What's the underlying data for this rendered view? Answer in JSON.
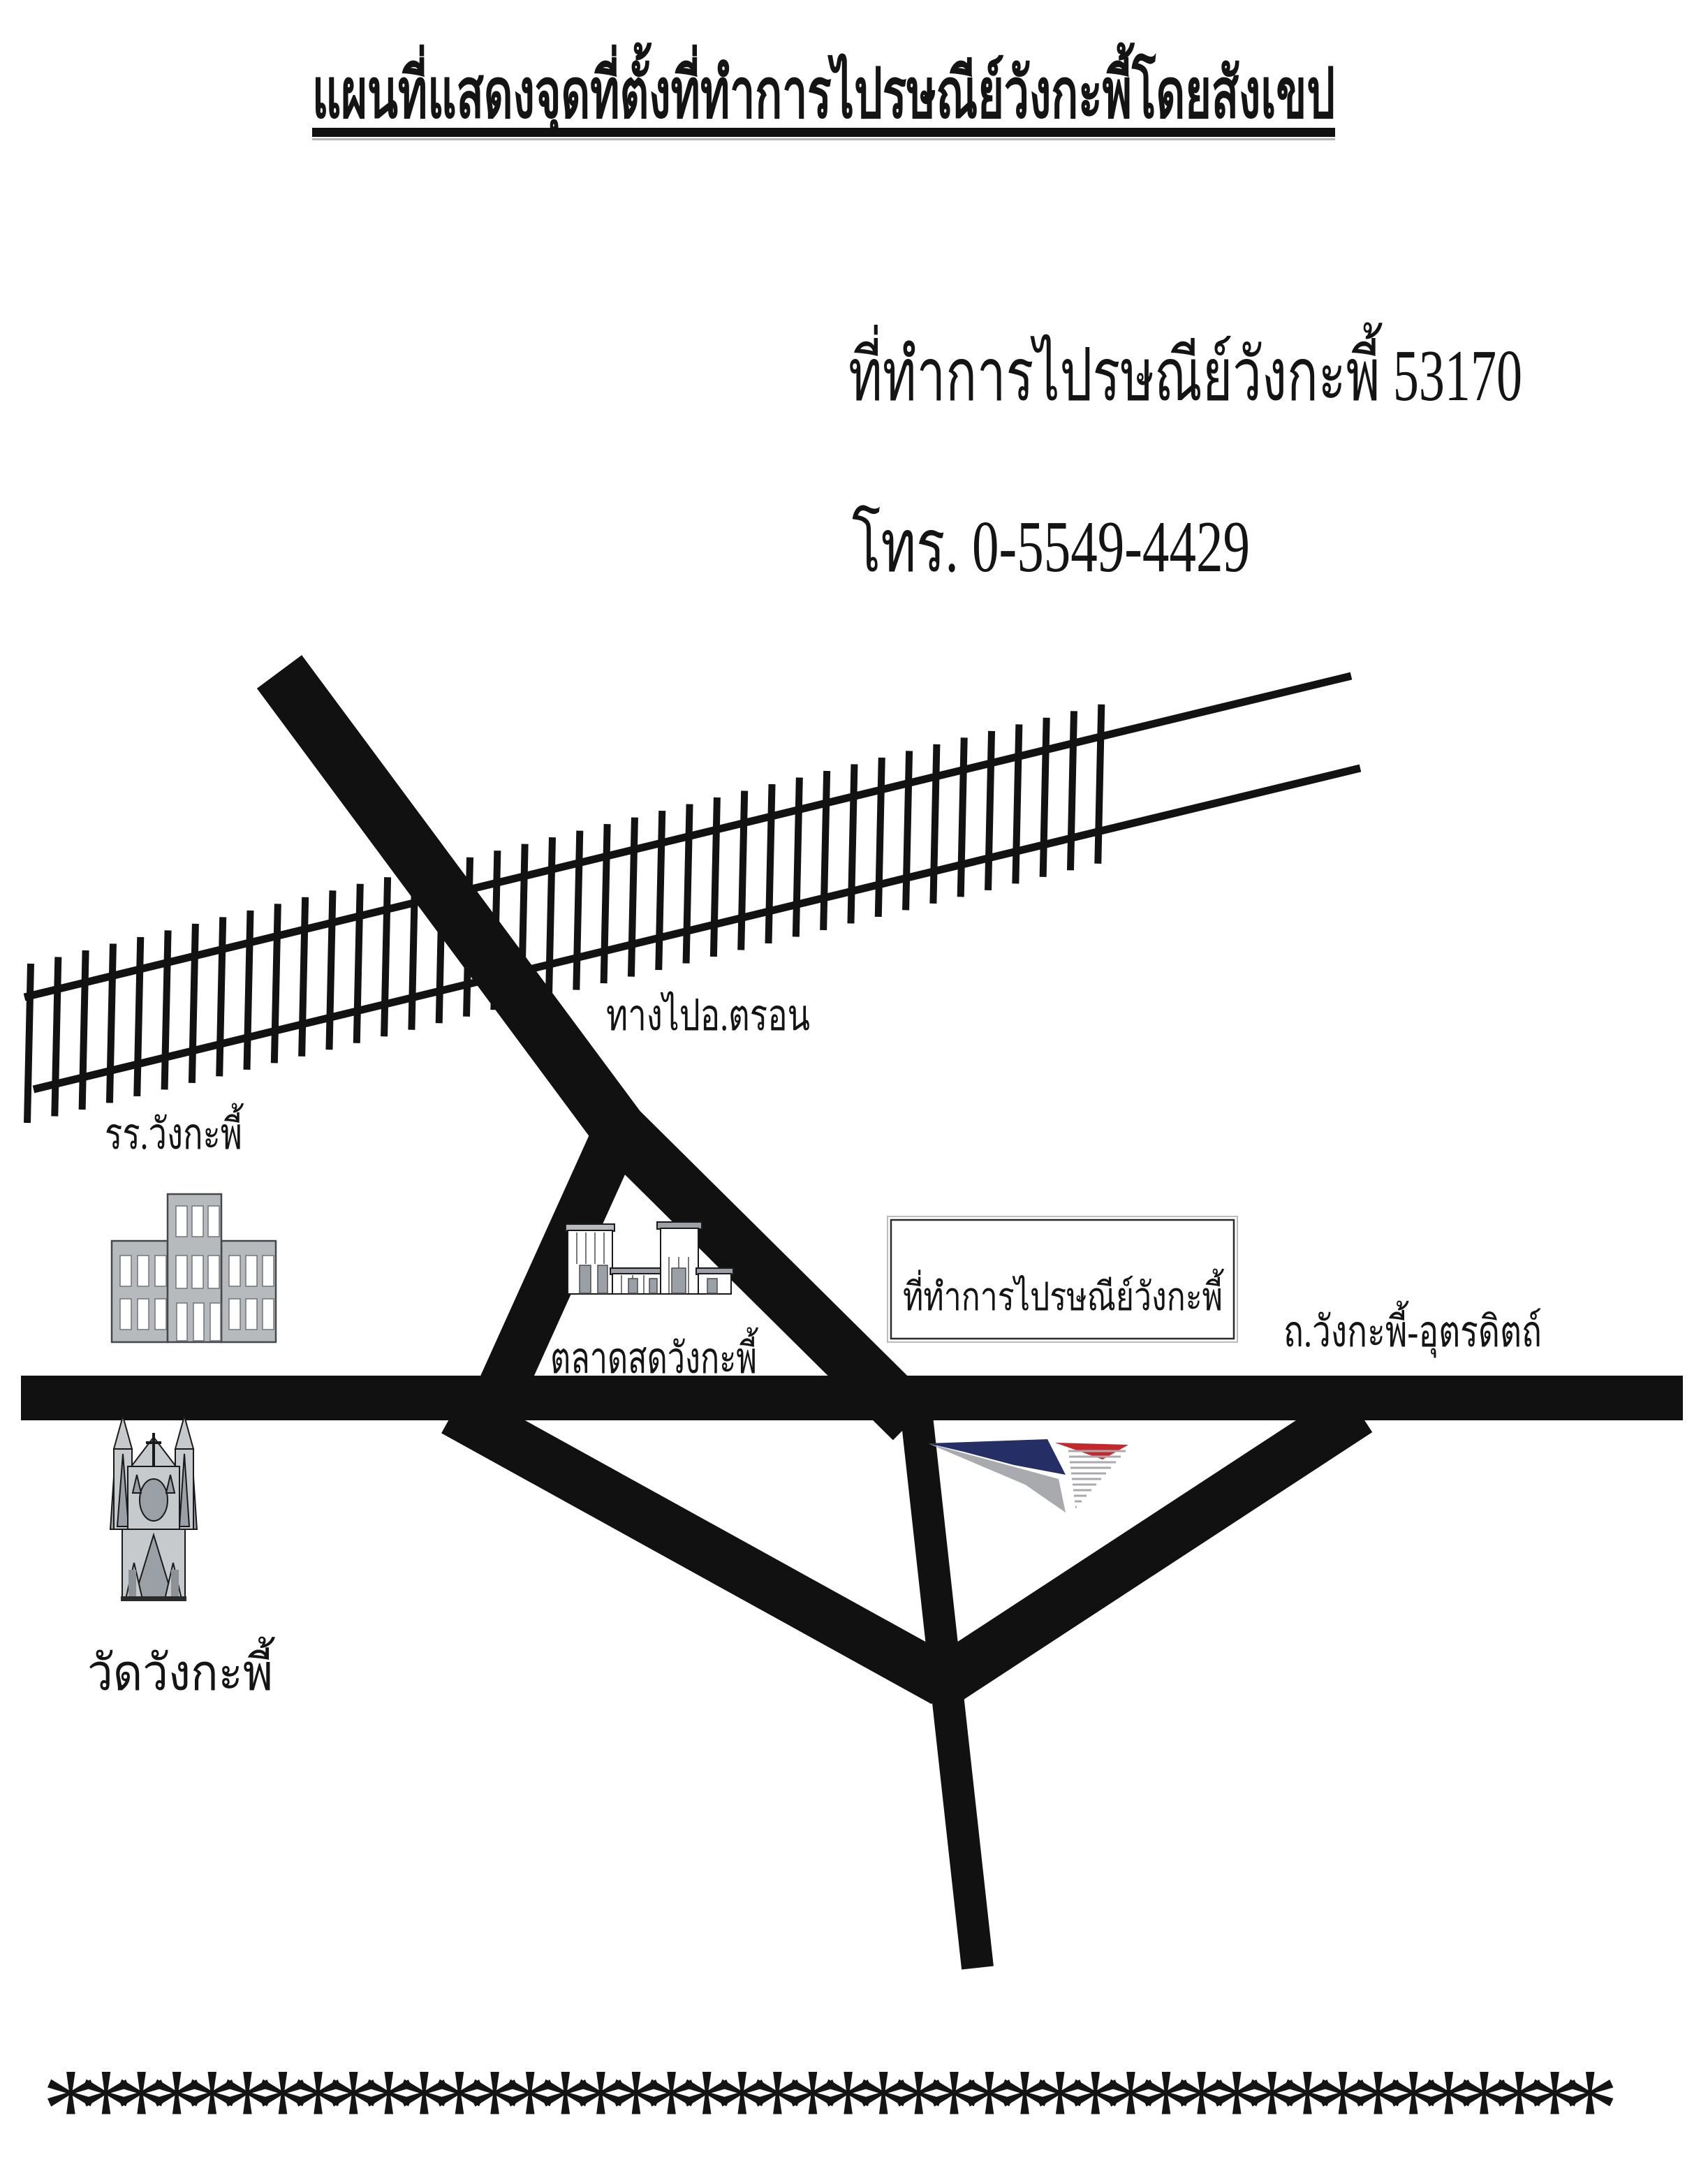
{
  "title": "แผนที่แสดงจุดที่ตั้งที่ทำการไปรษณีย์วังกะพี้โดยสังเขป",
  "header": {
    "office_line": "ที่ทำการไปรษณีย์วังกะพี้ 53170",
    "phone_line": "โทร. 0-5549-4429"
  },
  "map_labels": {
    "tron_direction": "ทางไปอ.ตรอน",
    "school": "รร.วังกะพี้",
    "market": "ตลาดสดวังกะพี้",
    "post_office_box": "ที่ทำการไปรษณีย์วังกะพี้",
    "main_road": "ถ.วังกะพี้-อุตรดิตถ์",
    "temple": "วัดวังกะพี้"
  },
  "icons": {
    "school": "school-building-icon",
    "market": "market-building-icon",
    "temple": "temple-icon",
    "post_logo": "thailand-post-logo-icon",
    "railway": "railway-track"
  },
  "footer": {
    "asterisk_row": "********************************************"
  },
  "colors": {
    "ink": "#121212",
    "road_black": "#111111",
    "logo_navy": "#262e66",
    "logo_red": "#c4272c",
    "logo_gray": "#a8aaae",
    "building_fill": "#b6babd",
    "building_detail": "#9aa0a5",
    "underline_shadow": "#b5b5b5"
  }
}
